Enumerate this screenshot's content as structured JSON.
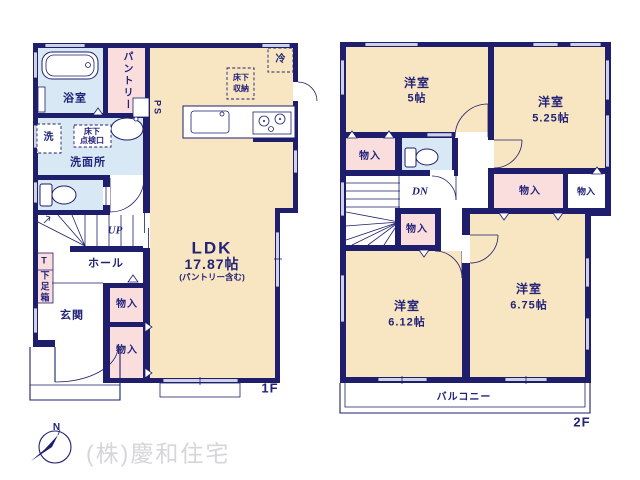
{
  "colors": {
    "wall": "#1e1e6c",
    "cream": "#f8e5c1",
    "pink": "#fadede",
    "blue": "#d8e9f5",
    "winfill": "#cdd2e6",
    "text": "#23237a",
    "watermark": "#d6d6da"
  },
  "compass": {
    "north": "N"
  },
  "watermark": {
    "company": "(株)慶和住宅"
  },
  "floor1": {
    "tag": "1F",
    "bathroom": "浴室",
    "pantry": "パントリー",
    "ps": "PS",
    "laundry": "洗",
    "inspection1": "床下",
    "inspection2": "点検口",
    "washroom": "洗面所",
    "fridge": "冷",
    "underfloor1": "床下",
    "underfloor2": "収納",
    "ldk": "LDK",
    "ldk_size": "17.87帖",
    "ldk_note": "(パントリー含む)",
    "up": "UP",
    "hall": "ホール",
    "shoe_t": "T",
    "shoe_box": "下足箱",
    "entrance": "玄関",
    "storage1": "物入",
    "storage2": "物入"
  },
  "floor2": {
    "tag": "2F",
    "room5": "洋室",
    "room5_size": "5帖",
    "room525": "洋室",
    "room525_size": "5.25帖",
    "room612": "洋室",
    "room612_size": "6.12帖",
    "room675": "洋室",
    "room675_size": "6.75帖",
    "storage_a": "物入",
    "storage_b": "物入",
    "storage_c": "物入",
    "storage_d": "物入",
    "dn": "DN",
    "balcony": "バルコニー"
  }
}
